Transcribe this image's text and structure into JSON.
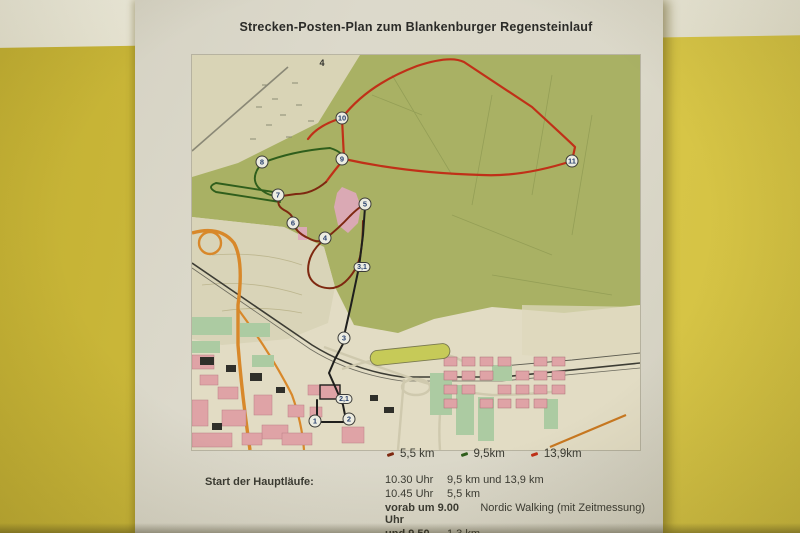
{
  "wall": {
    "top_band_color": "#eae8d8",
    "yellow_color": "#cfbc3d"
  },
  "poster": {
    "title": "Strecken-Posten-Plan zum Blankenburger Regensteinlauf",
    "map": {
      "trail_label": "4",
      "checkpoints": [
        {
          "num": "1",
          "x": 123,
          "y": 366
        },
        {
          "num": "2",
          "x": 157,
          "y": 364
        },
        {
          "num": "3",
          "x": 152,
          "y": 283
        },
        {
          "num": "4",
          "x": 133,
          "y": 183
        },
        {
          "num": "5",
          "x": 173,
          "y": 149
        },
        {
          "num": "6",
          "x": 101,
          "y": 168
        },
        {
          "num": "7",
          "x": 86,
          "y": 140
        },
        {
          "num": "8",
          "x": 70,
          "y": 107
        },
        {
          "num": "9",
          "x": 150,
          "y": 104
        },
        {
          "num": "10",
          "x": 150,
          "y": 63
        },
        {
          "num": "11",
          "x": 380,
          "y": 106
        }
      ],
      "distance_markers": [
        {
          "label": "3,1",
          "x": 170,
          "y": 212
        },
        {
          "label": "2,1",
          "x": 152,
          "y": 344
        }
      ],
      "route_colors": {
        "long": "#c03018",
        "mid": "#7e2810",
        "short": "#2f5e1c",
        "common": "#1f1f1d"
      }
    },
    "legend": {
      "items": [
        {
          "label": "5,5 km",
          "color": "#7e2810"
        },
        {
          "label": "9,5km",
          "color": "#2f5e1c"
        },
        {
          "label": "13,9km",
          "color": "#c03018"
        }
      ]
    },
    "schedule": {
      "heading": "Start der Hauptläufe:",
      "rows": [
        {
          "time": "10.30 Uhr",
          "bold": false,
          "desc": "9,5 km und 13,9 km"
        },
        {
          "time": "10.45 Uhr",
          "bold": false,
          "desc": "5,5 km"
        },
        {
          "time": "vorab um 9.00 Uhr",
          "bold": true,
          "desc": "Nordic Walking (mit Zeitmessung)"
        },
        {
          "time": "und 9.50",
          "bold": true,
          "desc": "1,3 km"
        }
      ]
    }
  }
}
